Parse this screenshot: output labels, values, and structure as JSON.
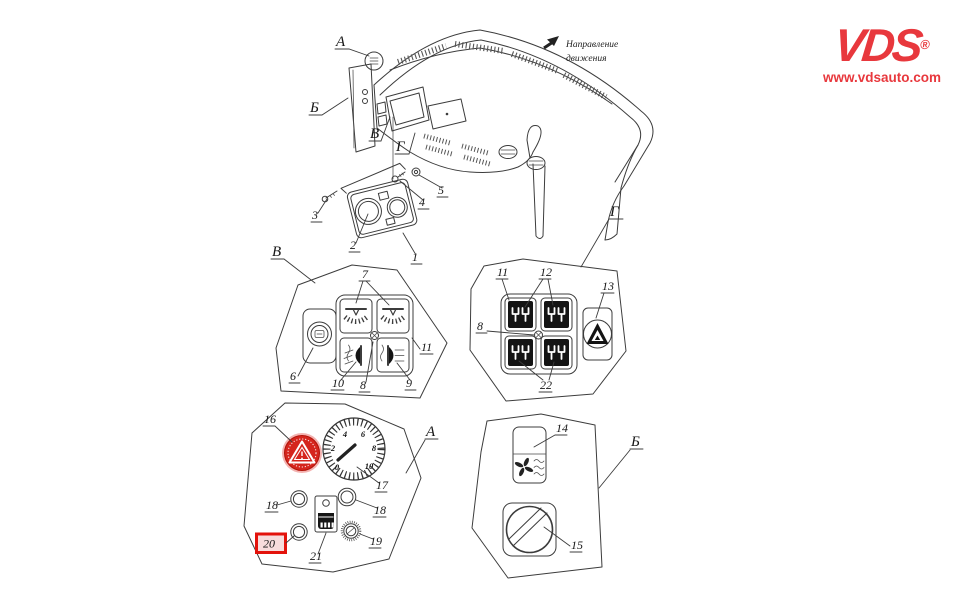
{
  "brand": {
    "logo_text": "VDS",
    "registered_mark": "®",
    "website": "www.vdsauto.com",
    "color": "#e8383d"
  },
  "direction_note": {
    "line1": "Направление",
    "line2": "движения"
  },
  "overview": {
    "label_a": "А",
    "label_b": "Б",
    "label_v": "В",
    "label_g": "Г",
    "callout_1": "1",
    "callout_2": "2",
    "callout_3": "3",
    "callout_4": "4",
    "callout_5": "5"
  },
  "detail_v": {
    "label": "В",
    "callout_6": "6",
    "callout_7": "7",
    "callout_8": "8",
    "callout_9": "9",
    "callout_10": "10",
    "callout_11": "11"
  },
  "detail_g": {
    "label": "Г",
    "callout_8": "8",
    "callout_11": "11",
    "callout_12": "12",
    "callout_13": "13",
    "callout_22": "22"
  },
  "detail_a": {
    "label": "А",
    "callout_16": "16",
    "callout_17": "17",
    "callout_18_left": "18",
    "callout_18_right": "18",
    "callout_19": "19",
    "callout_20": "20",
    "callout_21": "21"
  },
  "detail_b": {
    "label": "Б",
    "callout_14": "14",
    "callout_15": "15"
  },
  "tachometer": {
    "tick_labels": [
      "0",
      "2",
      "4",
      "6",
      "8",
      "10"
    ]
  },
  "highlight": {
    "box_color": "#e3120b",
    "part_color": "#d5251d"
  }
}
